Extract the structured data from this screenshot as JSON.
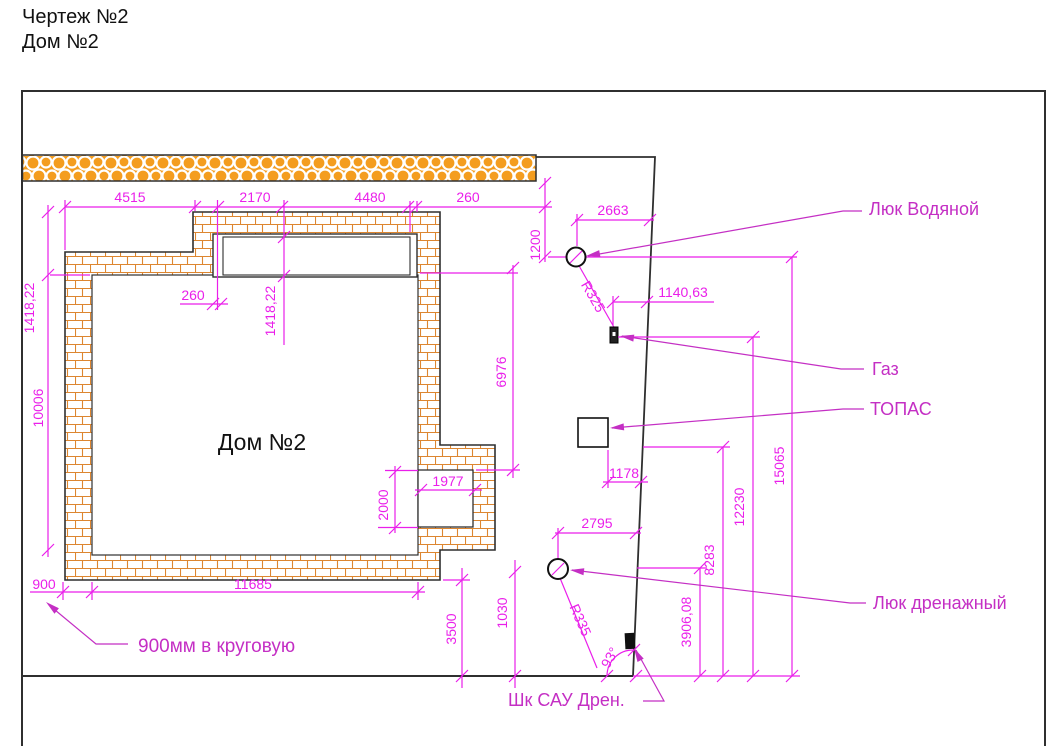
{
  "title": {
    "line1": "Чертеж №2",
    "line2": "Дом №2"
  },
  "house": {
    "label": "Дом №2"
  },
  "dims": {
    "top_4515": "4515",
    "top_2170": "2170",
    "top_4480": "4480",
    "top_260": "260",
    "win_offset_260": "260",
    "win_1418": "1418,22",
    "left_1418": "1418,22",
    "left_10006": "10006",
    "right_6976": "6976",
    "notch_1977": "1977",
    "notch_2000": "2000",
    "bot_900": "900",
    "bot_11685": "11685",
    "v_3500": "3500",
    "v_1030": "1030",
    "drain_2795": "2795",
    "drain_r335": "R335",
    "water_2663": "2663",
    "water_1200": "1200",
    "water_r325": "R325",
    "gas_1140": "1140,63",
    "topas_1178": "1178",
    "site_3906": "3906,08",
    "site_8283": "8283",
    "site_12230": "12230",
    "site_15065": "15065",
    "angle_93": "93°"
  },
  "callouts": {
    "water": "Люк Водяной",
    "gas": "Газ",
    "topas": "ТОПАС",
    "drain": "Люк дренажный",
    "cabinet": "Шк САУ Дрен.",
    "ring_note": "900мм в круговую"
  },
  "colors": {
    "dimension": "#EA1FEA",
    "callout": "#C42FC4",
    "brick_line": "#DD8630",
    "fence_fill": "#F49D1F",
    "outline": "#2F2F2F"
  }
}
